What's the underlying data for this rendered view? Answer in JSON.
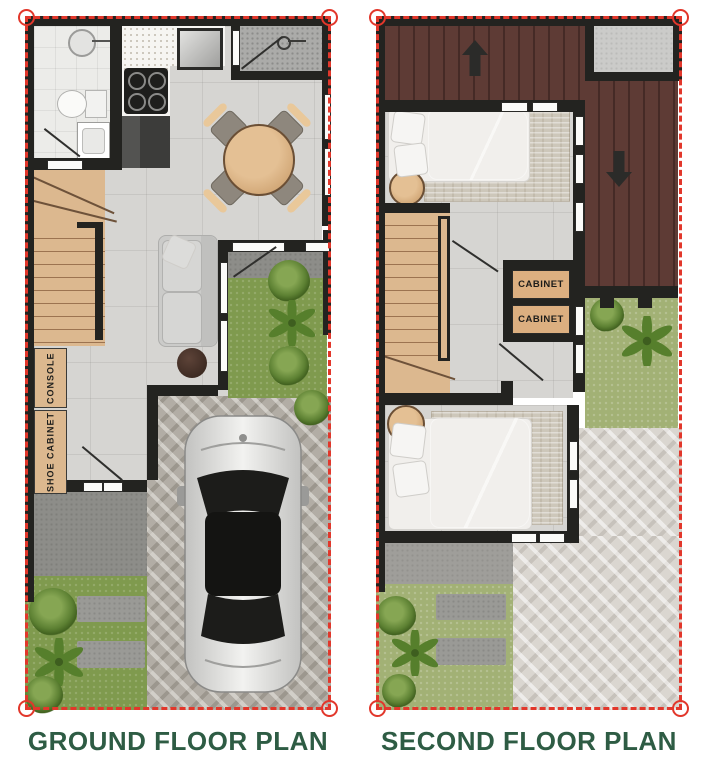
{
  "ground_floor": {
    "title": "GROUND FLOOR PLAN",
    "labels": {
      "console": "CONSOLE",
      "shoe_cabinet": "SHOE CABINET"
    }
  },
  "second_floor": {
    "title": "SECOND FLOOR PLAN",
    "labels": {
      "cabinet_1": "CABINET",
      "cabinet_2": "CABINET"
    }
  },
  "icons": {
    "up_arrow": "stairs-up-arrow",
    "down_arrow": "stairs-down-arrow",
    "car": "car-top-view",
    "corner_marker": "lot-corner-circle"
  },
  "colors": {
    "title_green": "#2e5c44",
    "boundary_red": "#e2372b",
    "wall": "#232320",
    "deck_brown": "#5e3b35",
    "deck_line": "#452a26",
    "wood": "#dcb88f",
    "wood_line": "#9c7350",
    "grass": "#7f9a4e",
    "grass_light": "#a2b175",
    "floor": "#d6d5d2",
    "floor_bath": "#ecece9",
    "paver": "#b2ada5",
    "paver_light": "#dad6d0",
    "concrete": "#8d8d89",
    "cabinet_tan": "#dcaf80"
  }
}
